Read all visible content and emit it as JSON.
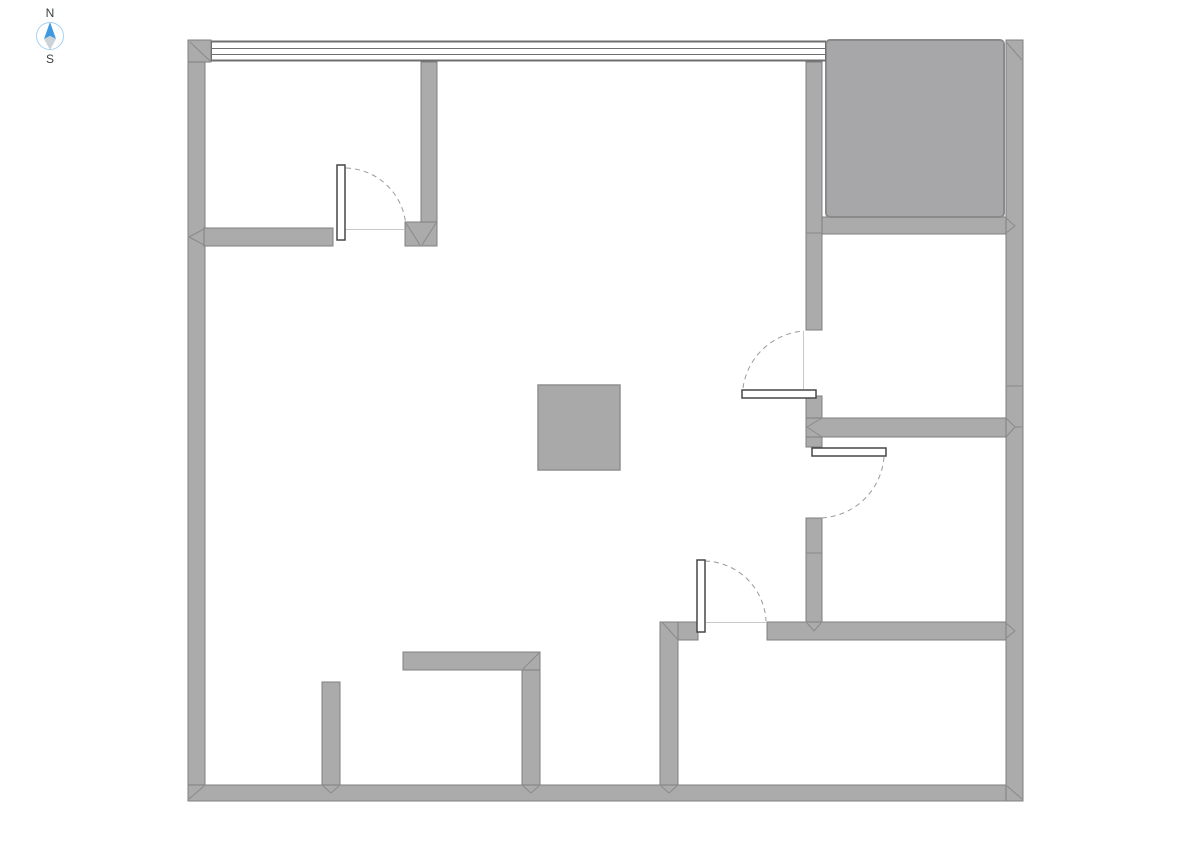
{
  "compass": {
    "north_label": "N",
    "south_label": "S",
    "ring_color": "#a9d2ef",
    "needle_north_color": "#3f99e0",
    "needle_south_color": "#ccd3d8"
  },
  "colors": {
    "background": "#ffffff",
    "wall_fill": "#ababab",
    "wall_stroke": "#7f7f7f",
    "miter_stroke": "#8a8a8a",
    "shaft_fill": "#a7a7aa",
    "shaft_stroke": "#8a8a8a",
    "column_fill": "#a9a9a9",
    "column_stroke": "#8f8f8f",
    "window_stroke": "#6f6f6f",
    "leaf_fill": "#ffffff",
    "leaf_stroke": "#474747",
    "arc_stroke": "#9a9a9a",
    "closed_line_stroke": "#c8c8c8"
  },
  "plan": {
    "canvas": {
      "width": 1191,
      "height": 842
    },
    "walls": [
      {
        "name": "outer-wall-left",
        "x": 188,
        "y": 40,
        "w": 17,
        "h": 761
      },
      {
        "name": "outer-wall-bottom",
        "x": 188,
        "y": 785,
        "w": 835,
        "h": 16
      },
      {
        "name": "outer-wall-right",
        "x": 1006,
        "y": 40,
        "w": 17,
        "h": 761
      },
      {
        "name": "corner-block-top-left",
        "x": 188,
        "y": 40,
        "w": 23,
        "h": 22
      },
      {
        "name": "room1-bottom-wall",
        "x": 204,
        "y": 228,
        "w": 129,
        "h": 18
      },
      {
        "name": "room1-right-wall",
        "x": 421,
        "y": 62,
        "w": 16,
        "h": 162
      },
      {
        "name": "room1-right-wall-foot",
        "x": 405,
        "y": 222,
        "w": 32,
        "h": 24
      },
      {
        "name": "east-wall-upper",
        "x": 806,
        "y": 62,
        "w": 16,
        "h": 268
      },
      {
        "name": "shaft-bottom-wall",
        "x": 822,
        "y": 217,
        "w": 184,
        "h": 17
      },
      {
        "name": "east-wall-mid-stub",
        "x": 806,
        "y": 396,
        "w": 16,
        "h": 51
      },
      {
        "name": "middle-right-wall",
        "x": 806,
        "y": 418,
        "w": 200,
        "h": 19
      },
      {
        "name": "east-wall-lower",
        "x": 806,
        "y": 518,
        "w": 16,
        "h": 104
      },
      {
        "name": "bottom-right-wall-west",
        "x": 662,
        "y": 622,
        "w": 36,
        "h": 18
      },
      {
        "name": "bottom-right-wall-east",
        "x": 767,
        "y": 622,
        "w": 239,
        "h": 18
      },
      {
        "name": "bottom-center-wall",
        "x": 660,
        "y": 622,
        "w": 18,
        "h": 163
      },
      {
        "name": "bottom-left-stub-wall",
        "x": 322,
        "y": 682,
        "w": 18,
        "h": 103
      },
      {
        "name": "l-wall-horizontal",
        "x": 403,
        "y": 652,
        "w": 137,
        "h": 18
      },
      {
        "name": "l-wall-vertical",
        "x": 522,
        "y": 670,
        "w": 18,
        "h": 115
      }
    ],
    "shaft": {
      "name": "shaft-block",
      "x": 826,
      "y": 40,
      "w": 178,
      "h": 177,
      "rx": 4
    },
    "column": {
      "name": "column-block",
      "x": 538,
      "y": 385,
      "w": 82,
      "h": 85
    },
    "window": {
      "lines": [
        {
          "x1": 211,
          "y1": 41.5,
          "x2": 826,
          "y2": 41.5,
          "w": 2
        },
        {
          "x1": 211,
          "y1": 48.5,
          "x2": 826,
          "y2": 48.5,
          "w": 1
        },
        {
          "x1": 211,
          "y1": 54.5,
          "x2": 826,
          "y2": 54.5,
          "w": 1
        },
        {
          "x1": 211,
          "y1": 60.5,
          "x2": 826,
          "y2": 60.5,
          "w": 2
        },
        {
          "x1": 211.5,
          "y1": 41,
          "x2": 211.5,
          "y2": 61,
          "w": 1
        },
        {
          "x1": 825.5,
          "y1": 41,
          "x2": 825.5,
          "y2": 61,
          "w": 1
        }
      ]
    },
    "doors": [
      {
        "name": "door-top-left-room",
        "leaf": {
          "x": 337,
          "y": 165,
          "w": 8,
          "h": 75
        },
        "arc": "M 346 168 A 62 62 0 0 1 406 229",
        "closed_line": {
          "x1": 345,
          "y1": 229.5,
          "x2": 405,
          "y2": 229.5
        }
      },
      {
        "name": "door-right-upper-room",
        "leaf": {
          "x": 742,
          "y": 390,
          "w": 74,
          "h": 8
        },
        "arc": "M 743 388 A 66 66 0 0 1 804 331",
        "closed_line": {
          "x1": 803.5,
          "y1": 331,
          "x2": 803.5,
          "y2": 389
        }
      },
      {
        "name": "door-right-lower-room",
        "leaf": {
          "x": 812,
          "y": 448,
          "w": 74,
          "h": 8
        },
        "arc": "M 884 457 A 66 66 0 0 1 819 518",
        "closed_line": null
      },
      {
        "name": "door-bottom-right-room",
        "leaf": {
          "x": 697,
          "y": 560,
          "w": 8,
          "h": 72
        },
        "arc": "M 705 561 A 63 63 0 0 1 766 621",
        "closed_line": {
          "x1": 706,
          "y1": 622.5,
          "x2": 766,
          "y2": 622.5
        }
      }
    ],
    "joints": [
      {
        "x1": 190,
        "y1": 42,
        "x2": 210,
        "y2": 61
      },
      {
        "x1": 204,
        "y1": 229,
        "x2": 189,
        "y2": 237
      },
      {
        "x1": 189,
        "y1": 237,
        "x2": 204,
        "y2": 245
      },
      {
        "x1": 189,
        "y1": 799,
        "x2": 204,
        "y2": 786
      },
      {
        "x1": 1022,
        "y1": 799,
        "x2": 1007,
        "y2": 786
      },
      {
        "x1": 1006,
        "y1": 42,
        "x2": 1022,
        "y2": 60
      },
      {
        "x1": 406,
        "y1": 223,
        "x2": 420,
        "y2": 245
      },
      {
        "x1": 436,
        "y1": 223,
        "x2": 422,
        "y2": 245
      },
      {
        "x1": 822,
        "y1": 418,
        "x2": 807,
        "y2": 427
      },
      {
        "x1": 807,
        "y1": 427,
        "x2": 822,
        "y2": 437
      },
      {
        "x1": 1006,
        "y1": 418,
        "x2": 1015,
        "y2": 427
      },
      {
        "x1": 1015,
        "y1": 427,
        "x2": 1006,
        "y2": 437
      },
      {
        "x1": 1015,
        "y1": 427,
        "x2": 1023,
        "y2": 427
      },
      {
        "x1": 1006,
        "y1": 386,
        "x2": 1023,
        "y2": 386
      },
      {
        "x1": 1006,
        "y1": 218,
        "x2": 1015,
        "y2": 226
      },
      {
        "x1": 1015,
        "y1": 226,
        "x2": 1006,
        "y2": 233
      },
      {
        "x1": 806,
        "y1": 233,
        "x2": 822,
        "y2": 233
      },
      {
        "x1": 806,
        "y1": 553,
        "x2": 822,
        "y2": 553
      },
      {
        "x1": 807,
        "y1": 623,
        "x2": 814,
        "y2": 631
      },
      {
        "x1": 814,
        "y1": 631,
        "x2": 821,
        "y2": 623
      },
      {
        "x1": 1006,
        "y1": 623,
        "x2": 1015,
        "y2": 631
      },
      {
        "x1": 1015,
        "y1": 631,
        "x2": 1006,
        "y2": 638
      },
      {
        "x1": 661,
        "y1": 786,
        "x2": 669,
        "y2": 793
      },
      {
        "x1": 669,
        "y1": 793,
        "x2": 677,
        "y2": 786
      },
      {
        "x1": 323,
        "y1": 786,
        "x2": 331,
        "y2": 793
      },
      {
        "x1": 331,
        "y1": 793,
        "x2": 339,
        "y2": 786
      },
      {
        "x1": 523,
        "y1": 786,
        "x2": 531,
        "y2": 793
      },
      {
        "x1": 531,
        "y1": 793,
        "x2": 539,
        "y2": 786
      },
      {
        "x1": 539,
        "y1": 653,
        "x2": 523,
        "y2": 669
      },
      {
        "x1": 662,
        "y1": 622,
        "x2": 678,
        "y2": 640
      }
    ]
  }
}
